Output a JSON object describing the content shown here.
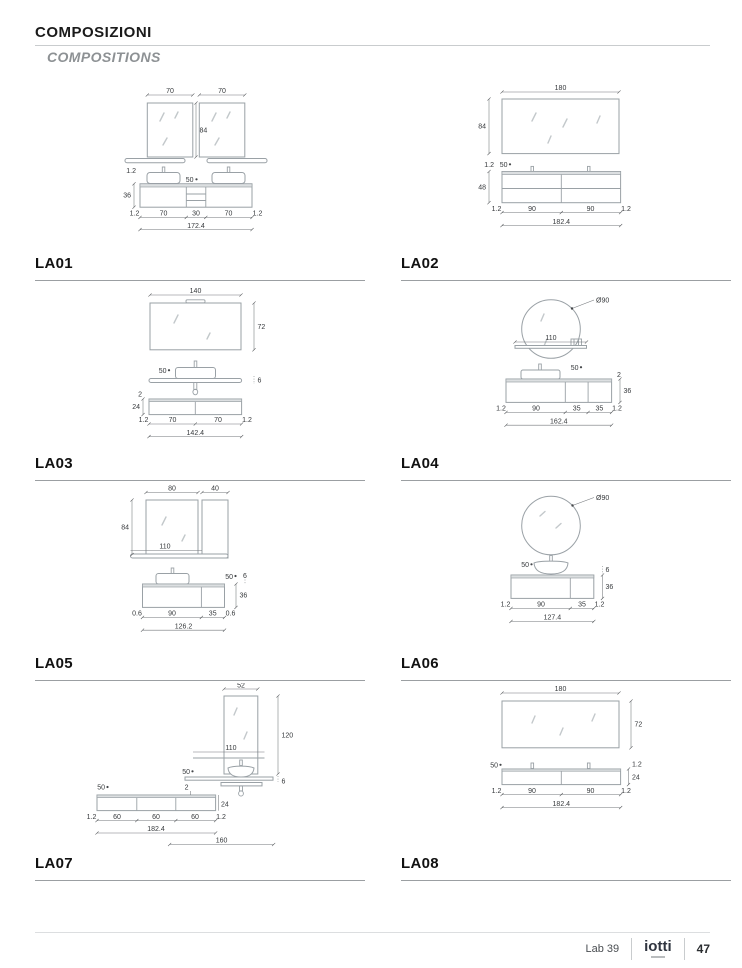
{
  "header": {
    "title": "COMPOSIZIONI",
    "subtitle": "COMPOSITIONS"
  },
  "footer": {
    "collection": "Lab 39",
    "brand": "iotti",
    "page": "47"
  },
  "palette": {
    "drawing_line": "#9aa1a6",
    "dim_text": "#36393c",
    "label": "#111111",
    "divider": "#9b9fa2"
  },
  "compositions": [
    {
      "id": "LA01",
      "dims": {
        "m1w": "70",
        "m2w": "70",
        "mh": "84",
        "lip": "1.2",
        "h": "36",
        "depth": "50",
        "bottom": [
          "1.2",
          "70",
          "30",
          "70",
          "1.2"
        ],
        "total": "172.4"
      }
    },
    {
      "id": "LA02",
      "dims": {
        "mw": "180",
        "mh": "84",
        "lip": "1.2",
        "depth": "50",
        "h": "48",
        "bottom": [
          "1.2",
          "90",
          "90",
          "1.2"
        ],
        "total": "182.4"
      }
    },
    {
      "id": "LA03",
      "dims": {
        "mw": "140",
        "mh": "72",
        "depth": "50",
        "shelf": "6",
        "lip": "2",
        "h": "24",
        "bottom": [
          "1.2",
          "70",
          "70",
          "1.2"
        ],
        "total": "142.4"
      }
    },
    {
      "id": "LA04",
      "dims": {
        "md": "Ø90",
        "sw": "110",
        "depth": "50",
        "lip": "2",
        "h": "36",
        "bottom": [
          "1.2",
          "90",
          "35",
          "35",
          "1.2"
        ],
        "total": "162.4"
      }
    },
    {
      "id": "LA05",
      "dims": {
        "mw": "80",
        "cw": "40",
        "mh": "84",
        "sw": "110",
        "depth": "50",
        "shelf": "6",
        "h": "36",
        "bottom": [
          "0.6",
          "90",
          "35",
          "0.6"
        ],
        "total": "126.2"
      }
    },
    {
      "id": "LA06",
      "dims": {
        "md": "Ø90",
        "depth": "50",
        "shelf": "6",
        "h": "36",
        "bottom": [
          "1.2",
          "90",
          "35",
          "1.2"
        ],
        "total": "127.4"
      }
    },
    {
      "id": "LA07",
      "dims": {
        "mw": "52",
        "mh": "120",
        "sw": "110",
        "depth": "50",
        "shelf": "6",
        "depth2": "50",
        "lip": "2",
        "h": "24",
        "bottom": [
          "1.2",
          "60",
          "60",
          "60",
          "1.2"
        ],
        "total": "182.4",
        "offset": "160"
      }
    },
    {
      "id": "LA08",
      "dims": {
        "mw": "180",
        "mh": "72",
        "depth": "50",
        "lip": "1.2",
        "h": "24",
        "bottom": [
          "1.2",
          "90",
          "90",
          "1.2"
        ],
        "total": "182.4"
      }
    }
  ]
}
